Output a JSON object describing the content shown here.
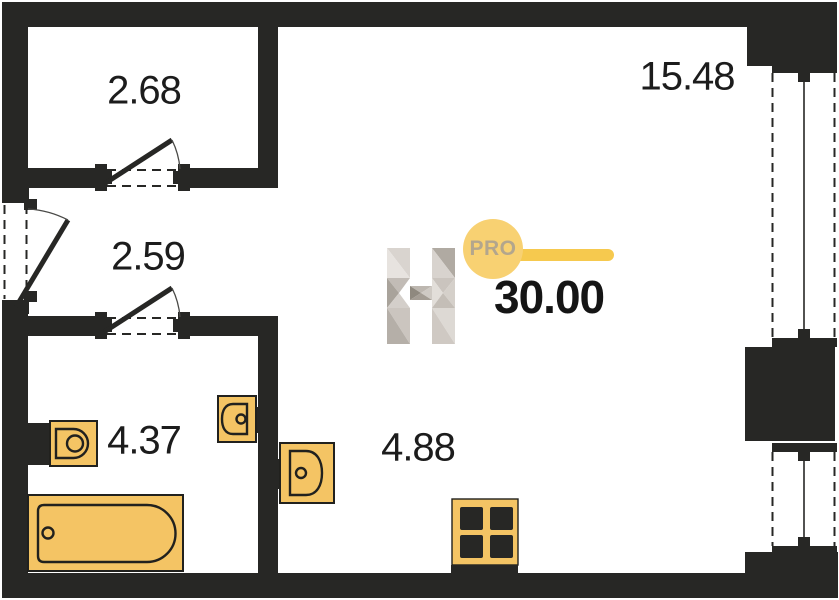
{
  "title": "Studio apartment floor plan",
  "total_area": "30.00",
  "rooms": [
    {
      "id": "closet",
      "area": "2.68"
    },
    {
      "id": "living-room",
      "area": "15.48"
    },
    {
      "id": "hallway",
      "area": "2.59"
    },
    {
      "id": "bathroom",
      "area": "4.37"
    },
    {
      "id": "kitchen-zone",
      "area": "4.88"
    }
  ],
  "logo": {
    "letter": "H",
    "badge": "PRO"
  },
  "fixtures": [
    "toilet",
    "bathtub",
    "bathroom-sink",
    "kitchen-sink",
    "stove"
  ],
  "features": {
    "windows": 2,
    "doors": 3
  },
  "colors": {
    "wall": "#272725",
    "fixture_fill": "#F4C464",
    "fixture_outline": "#21211E",
    "logo_circle": "#F8D172",
    "logo_bar": "#F6C94E",
    "logo_badge_text": "#B3A68D",
    "label_text": "#1C1C1C"
  }
}
